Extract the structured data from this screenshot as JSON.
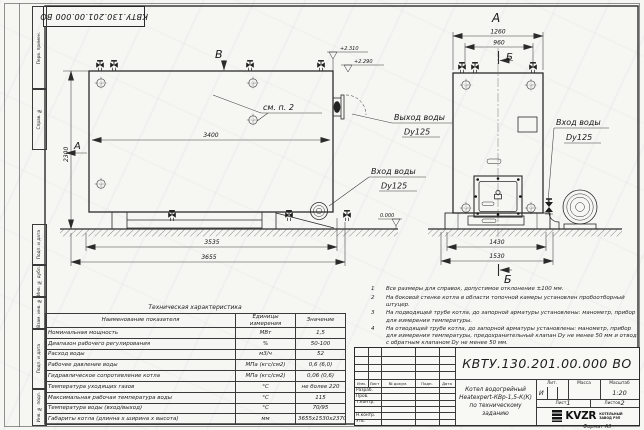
{
  "designation": "КВТУ.130.201.00.000  ВО",
  "margin": {
    "labels": [
      "Перв. примен.",
      "Справ. №",
      "Подп. и дата",
      "Инв. № дубл.",
      "Взам. инв. №",
      "Подп. и дата",
      "Инв. № подл."
    ]
  },
  "views": {
    "side": {
      "marker_b": "В",
      "marker_a": "А",
      "elev_high": "+2.310",
      "elev_low": "+2.290",
      "see_note": "см. п. 2",
      "dim_inner_width": "3400",
      "dim_height": "2300",
      "dim_base": "3535",
      "dim_overall": "3655",
      "outlet_line1": "Выход воды",
      "outlet_line2": "Dy125",
      "inlet_line1": "Вход воды",
      "inlet_line2": "Dy125"
    },
    "front": {
      "marker_a": "А",
      "marker_b_top": "Б",
      "marker_b_bottom": "Б",
      "dim_top_outer": "1260",
      "dim_top_inner": "960",
      "dim_base": "1430",
      "dim_overall": "1530",
      "inlet_line1": "Вход воды",
      "inlet_line2": "Dy125",
      "elev_zero": "0.000"
    }
  },
  "notes": [
    {
      "n": "1",
      "text": "Все размеры для справок, допустимое отклонение ±100 мм."
    },
    {
      "n": "2",
      "text": "На боковой стенке котла в области топочной камеры установлен пробоотборный штуцер."
    },
    {
      "n": "3",
      "text": "На  подводящей трубе котла, до запорной арматуры установлены:  манометр, прибор для измерения температуры."
    },
    {
      "n": "4",
      "text": "На отводящей трубе котла, до запорной арматуры установлены:  манометр, прибор для измерения температуры, предохранительный клапан Dу не менее 50 мм и отвод с обратным клапаном Dу не менее 50 мм."
    }
  ],
  "spec_table": {
    "title": "Техническая характеристика",
    "headers": [
      "Наименование показателя",
      "Единицы измерения",
      "Значение"
    ],
    "rows": [
      [
        "Номинальная мощность",
        "МВт",
        "1,5"
      ],
      [
        "Диапазон рабочего регулирования",
        "%",
        "50-100"
      ],
      [
        "Расход воды",
        "м3/ч",
        "52"
      ],
      [
        "Рабочее давление воды",
        "МПа (кгс/см2)",
        "0,6 (6,0)"
      ],
      [
        "Гидравлическое сопротивление котла",
        "МПа (кгс/см2)",
        "0,06 (0,6)"
      ],
      [
        "Температура уходящих газов",
        "°С",
        "не более 220"
      ],
      [
        "Максимальная рабочая температура воды",
        "°С",
        "115"
      ],
      [
        "Температура воды (вход/выход)",
        "°С",
        "70/95"
      ],
      [
        "Габариты котла (длинна х ширина х высота)",
        "мм",
        "3655х1530х2370"
      ]
    ]
  },
  "title_block": {
    "product_line1": "Котел водогрейный",
    "product_line2": "Heatexpert-КВр-1,5-К(К)",
    "product_line3": "по техническому заданию",
    "header_cols": [
      "Изм.",
      "Лист",
      "№ докум.",
      "Подп.",
      "Дата"
    ],
    "sign_rows": [
      "Разраб.",
      "Пров.",
      "Т.контр.",
      "",
      "Н.контр.",
      "Утв."
    ],
    "lit_label": "Лит.",
    "lit_value": "И",
    "mass_label": "Масса",
    "scale_label": "Масштаб",
    "scale_value": "1:20",
    "sheet_label": "Лист",
    "sheet_value": "1",
    "sheets_label": "Листов",
    "sheets_value": "2",
    "logo": "KVZR",
    "logo_sub1": "КОТЕЛЬНЫЙ",
    "logo_sub2": "ЗАВОД РЭП",
    "format_text": "Формат  А3"
  }
}
